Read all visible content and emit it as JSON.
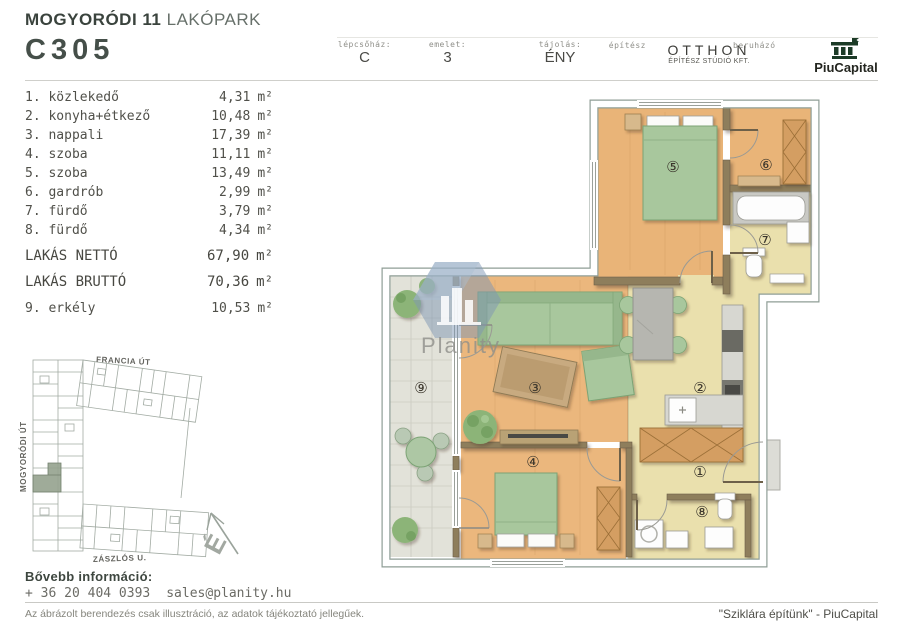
{
  "header": {
    "project_title_bold": "MOGYORÓDI 11",
    "project_title_light": "LAKÓPARK",
    "unit_code": "C305",
    "meta": {
      "staircase_label": "lépcsőház:",
      "staircase_value": "C",
      "floor_label": "emelet:",
      "floor_value": "3",
      "orientation_label": "tájolás:",
      "orientation_value": "ÉNY",
      "architect_label": "építész",
      "architect_name": "OTTHON",
      "architect_subtitle": "ÉPÍTÉSZ STÚDIÓ KFT.",
      "developer_label": "beruházó",
      "developer_name": "PiuCapital"
    }
  },
  "room_list": {
    "unit": "m²",
    "rooms": [
      {
        "num": "1.",
        "name": "közlekedő",
        "area": "4,31"
      },
      {
        "num": "2.",
        "name": "konyha+étkező",
        "area": "10,48"
      },
      {
        "num": "3.",
        "name": "nappali",
        "area": "17,39"
      },
      {
        "num": "4.",
        "name": "szoba",
        "area": "11,11"
      },
      {
        "num": "5.",
        "name": "szoba",
        "area": "13,49"
      },
      {
        "num": "6.",
        "name": "gardrób",
        "area": "2,99"
      },
      {
        "num": "7.",
        "name": "fürdő",
        "area": "3,79"
      },
      {
        "num": "8.",
        "name": "fürdő",
        "area": "4,34"
      }
    ],
    "totals": [
      {
        "label": "LAKÁS NETTÓ",
        "area": "67,90"
      },
      {
        "label": "LAKÁS BRUTTÓ",
        "area": "70,36"
      }
    ],
    "balcony": {
      "num": "9.",
      "name": "erkély",
      "area": "10,53"
    }
  },
  "site_map": {
    "street_top": "FRANCIA ÚT",
    "street_left": "MOGYORÓDI ÚT",
    "street_bottom": "ZÁSZLÓS U.",
    "compass_letter": "É"
  },
  "floor_plan": {
    "watermark": "Planity",
    "room_labels": [
      "①",
      "②",
      "③",
      "④",
      "⑤",
      "⑥",
      "⑦",
      "⑧",
      "⑨"
    ]
  },
  "footer": {
    "info_title": "Bővebb információ:",
    "phone": "+ 36 20 404 0393",
    "email": "sales@planity.hu",
    "disclaimer": "Az ábrázolt berendezés csak illusztráció, az adatok tájékoztató jellegűek.",
    "slogan": "\"Sziklára építünk\" - PiuCapital"
  },
  "colors": {
    "accent_dark": "#3a433d",
    "wood_floor": "#e8b377",
    "pale_floor": "#eae0ad",
    "balcony_floor": "#e4e4db",
    "wall_brown": "#8e7e5c",
    "furniture_green": "#a8c79d",
    "highlight_unit": "#95a28e",
    "logo_green": "#1c3b27"
  }
}
